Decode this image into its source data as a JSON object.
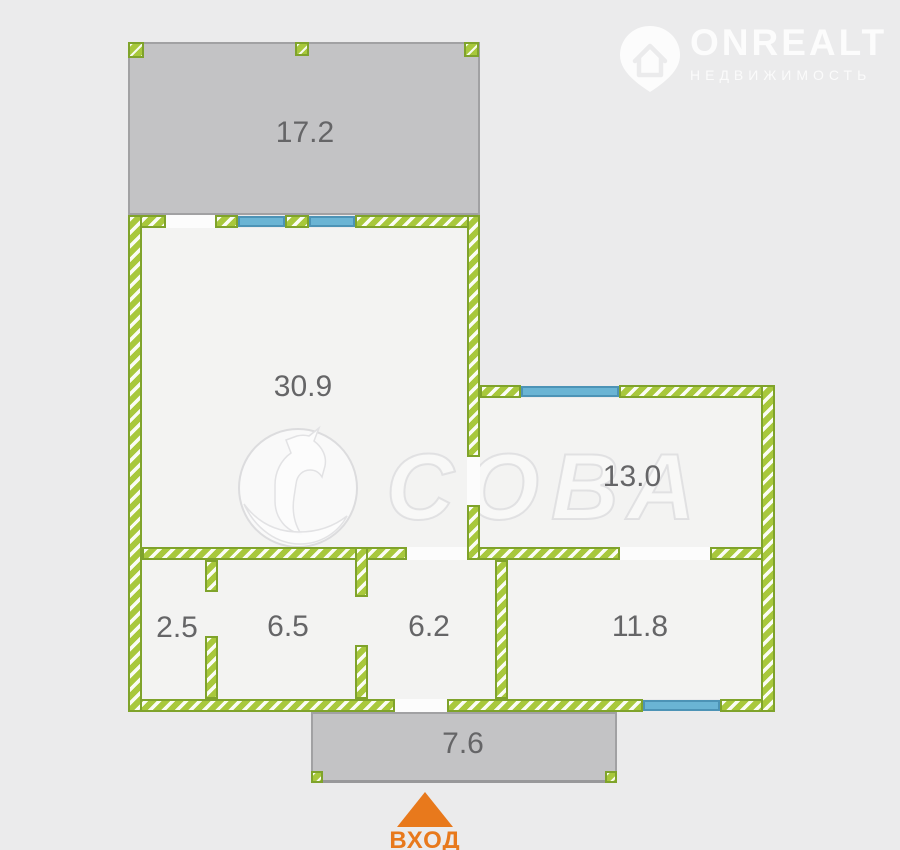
{
  "page": {
    "background": "#ebebec"
  },
  "brand_watermark": {
    "name": "ONREALT",
    "subtitle": "НЕДВИЖИМОСТЬ"
  },
  "center_watermark": {
    "text": "СОВА"
  },
  "floorplan": {
    "entrance_label": "ВХОД",
    "rooms": [
      {
        "id": "balcony",
        "area": "17.2"
      },
      {
        "id": "living-room",
        "area": "30.9"
      },
      {
        "id": "room-right-upper",
        "area": "13.0"
      },
      {
        "id": "wc",
        "area": "2.5"
      },
      {
        "id": "bathroom",
        "area": "6.5"
      },
      {
        "id": "hallway",
        "area": "6.2"
      },
      {
        "id": "room-right-lower",
        "area": "11.8"
      },
      {
        "id": "porch",
        "area": "7.6"
      }
    ],
    "colors": {
      "wall_green": "#a8c83c",
      "wall_green_dark": "#7fa32b",
      "window_blue": "#6ab4d4",
      "window_blue_dark": "#4c93b6",
      "balcony_gray": "#c3c3c5",
      "balcony_border": "#a1a1a3",
      "room_fill": "#f3f3f2",
      "label_gray": "#656567",
      "entrance_orange": "#e8791c"
    }
  }
}
